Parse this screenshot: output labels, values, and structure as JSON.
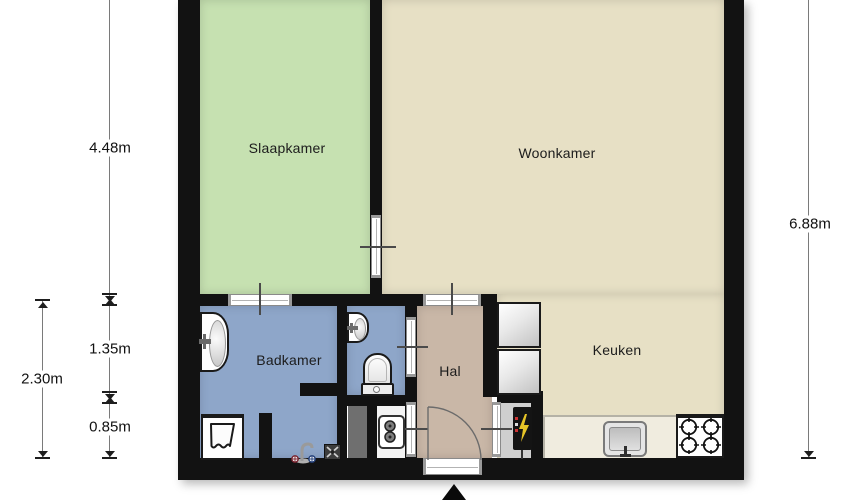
{
  "palette": {
    "wall": "#121212",
    "dim-line": "#7a7a7a",
    "dim-mark": "#1e1e1e",
    "dim-text": "#111111",
    "room-text": "#1c1c1c",
    "door-line": "#4a4a4a"
  },
  "rooms": {
    "slaapkamer": {
      "label": "Slaapkamer",
      "color": "#c6e1b1"
    },
    "woonkamer": {
      "label": "Woonkamer",
      "color": "#e7e0c5"
    },
    "badkamer": {
      "label": "Badkamer",
      "color": "#8ea6c9"
    },
    "wc": {
      "color": "#8ea6c9"
    },
    "hal": {
      "label": "Hal",
      "color": "#c9b7a7"
    },
    "keuken": {
      "label": "Keuken",
      "color": "#e7e0c5"
    },
    "meterkast": {
      "color": "#cfcfcf"
    },
    "boiler_room": {
      "color": "#f3f3f3"
    },
    "shaft": {
      "color": "#6f6f6f"
    },
    "counter": {
      "color": "#f0ecdf"
    }
  },
  "dimensions": {
    "bedroom_height": "4.48m",
    "bathroom_upper": "1.35m",
    "bathroom_lower": "0.85m",
    "bathroom_total": "2.30m",
    "right_total": "6.88m"
  },
  "icons": [
    "bathroom-sink-icon",
    "wc-sink-icon",
    "toilet-icon",
    "washing-machine-icon",
    "tap-icon",
    "floor-drain-icon",
    "boiler-icon",
    "electrical-panel-icon",
    "tall-cabinet-icon",
    "kitchen-sink-icon",
    "stove-icon",
    "door-swing-icon",
    "entrance-arrow-icon"
  ]
}
